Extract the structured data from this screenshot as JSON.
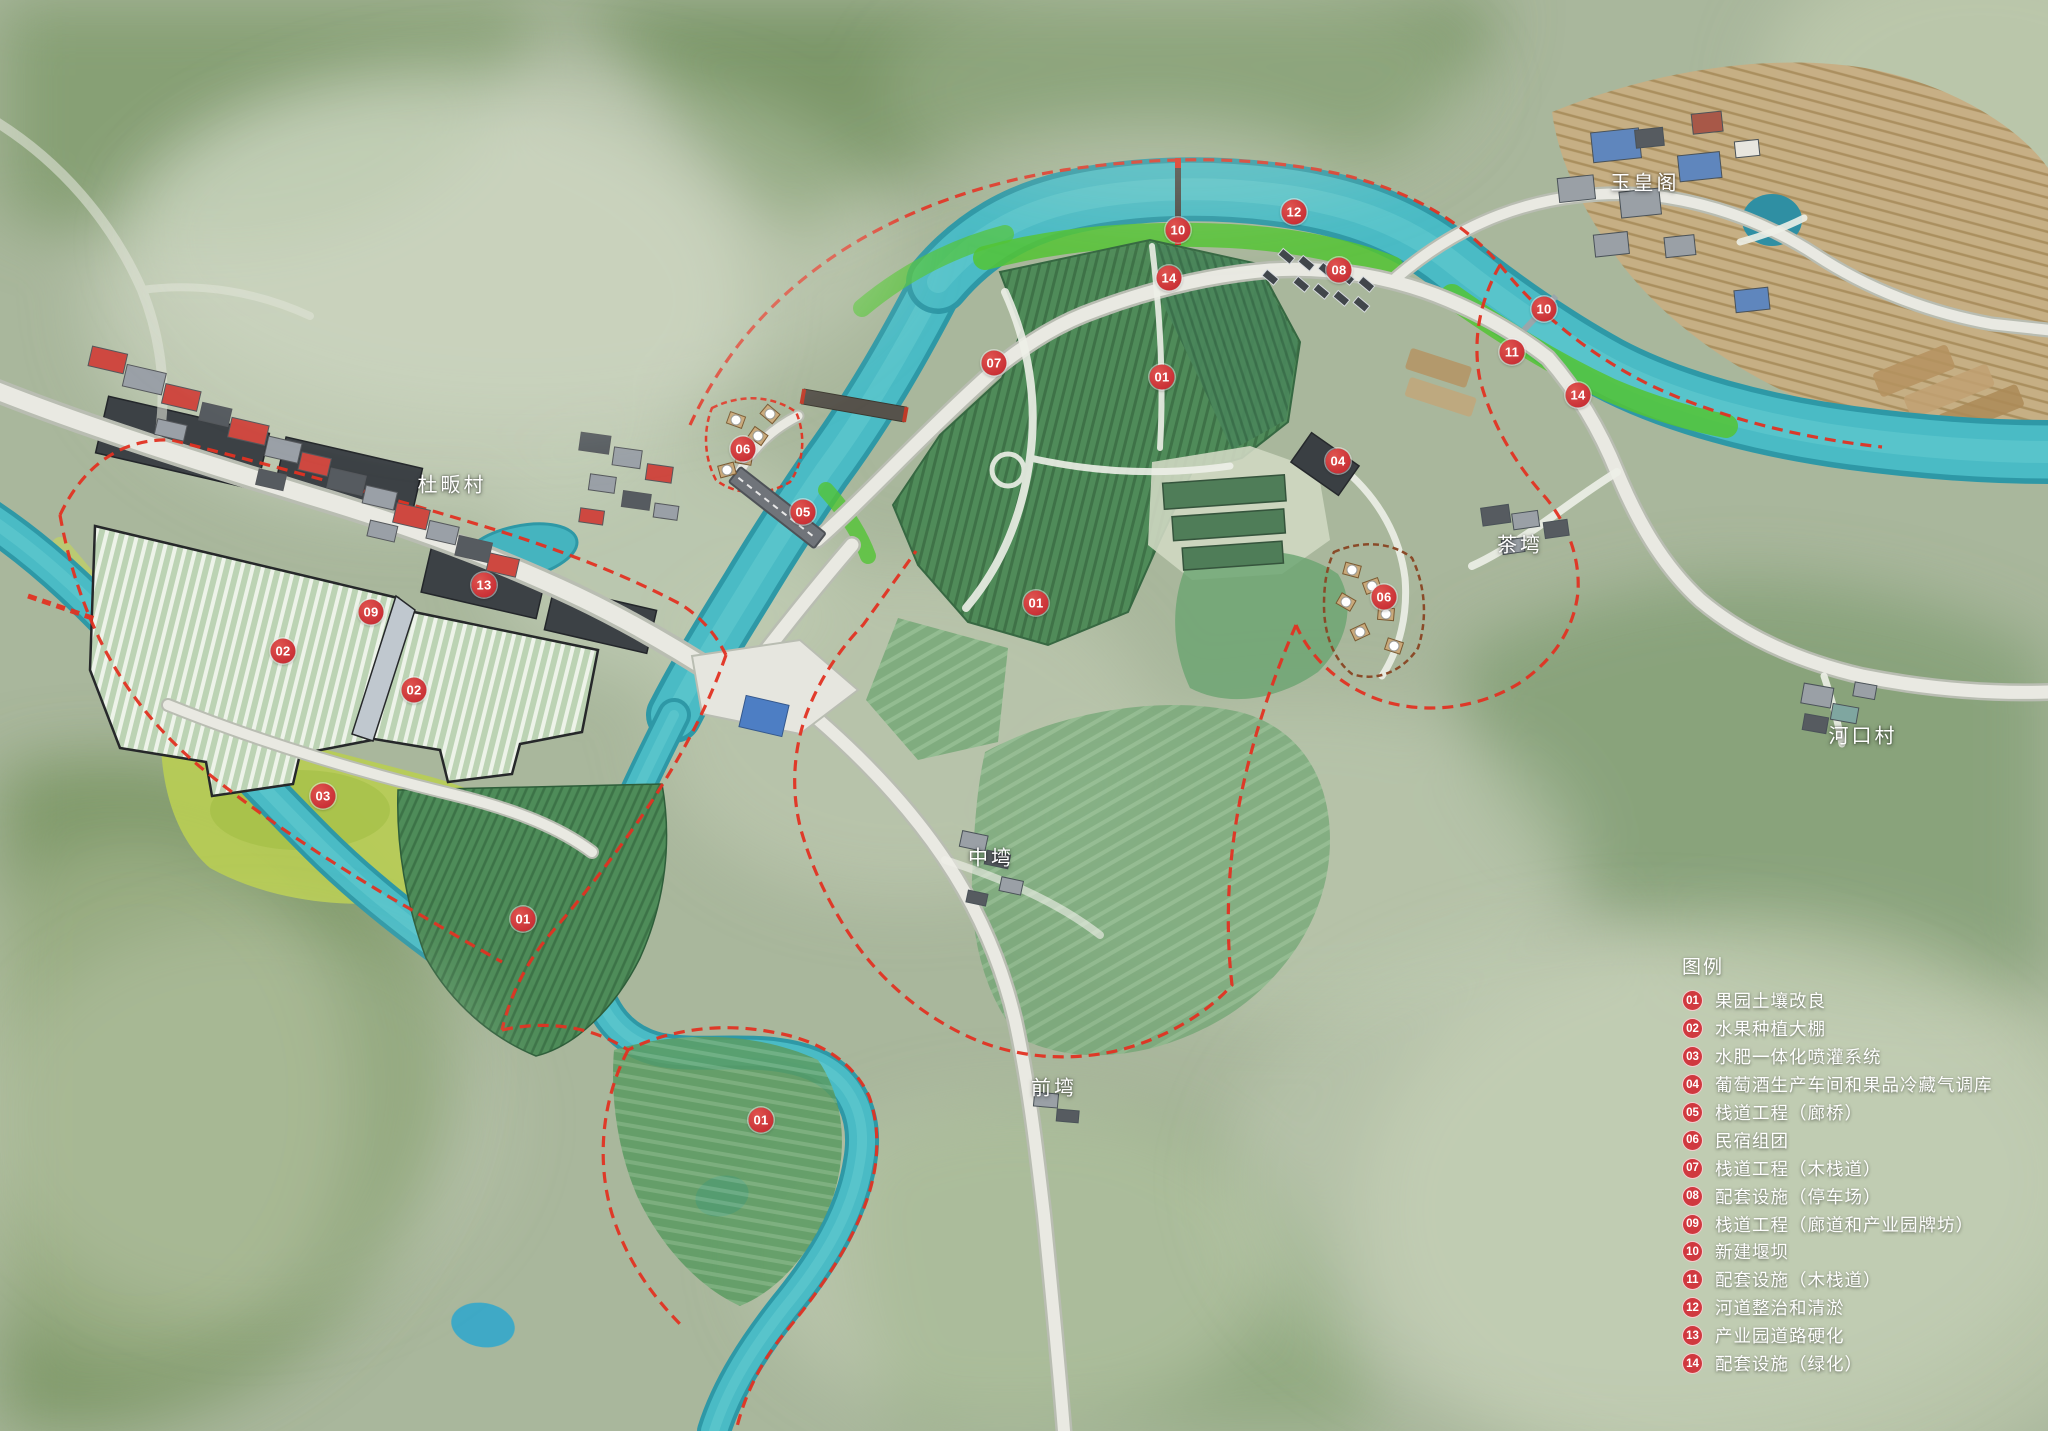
{
  "colors": {
    "marker_red": "#ce383e",
    "badge_red": "#d0393f",
    "river_teal": "#4abbc5",
    "greening_green": "#53c434",
    "boundary_red": "#e23222",
    "label_white": "#ffffff"
  },
  "legend": {
    "title": "图例",
    "items": [
      {
        "num": "01",
        "label": "果园土壤改良"
      },
      {
        "num": "02",
        "label": "水果种植大棚"
      },
      {
        "num": "03",
        "label": "水肥一体化喷灌系统"
      },
      {
        "num": "04",
        "label": "葡萄酒生产车间和果品冷藏气调库"
      },
      {
        "num": "05",
        "label": "栈道工程（廊桥）"
      },
      {
        "num": "06",
        "label": "民宿组团"
      },
      {
        "num": "07",
        "label": "栈道工程（木栈道）"
      },
      {
        "num": "08",
        "label": "配套设施（停车场）"
      },
      {
        "num": "09",
        "label": "栈道工程（廊道和产业园牌坊）"
      },
      {
        "num": "10",
        "label": "新建堰坝"
      },
      {
        "num": "11",
        "label": "配套设施（木栈道）"
      },
      {
        "num": "12",
        "label": "河道整治和清淤"
      },
      {
        "num": "13",
        "label": "产业园道路硬化"
      },
      {
        "num": "14",
        "label": "配套设施（绿化）"
      }
    ]
  },
  "places": [
    {
      "name": "玉皇阁",
      "x": 1645,
      "y": 181
    },
    {
      "name": "杜畈村",
      "x": 452,
      "y": 483
    },
    {
      "name": "中塆",
      "x": 991,
      "y": 856
    },
    {
      "name": "前塆",
      "x": 1054,
      "y": 1086
    },
    {
      "name": "茶塆",
      "x": 1520,
      "y": 543
    },
    {
      "name": "河口村",
      "x": 1863,
      "y": 734
    }
  ],
  "markers": [
    {
      "num": "12",
      "x": 1294,
      "y": 212
    },
    {
      "num": "10",
      "x": 1178,
      "y": 230
    },
    {
      "num": "14",
      "x": 1169,
      "y": 278
    },
    {
      "num": "08",
      "x": 1339,
      "y": 270
    },
    {
      "num": "10",
      "x": 1544,
      "y": 309
    },
    {
      "num": "11",
      "x": 1512,
      "y": 352
    },
    {
      "num": "14",
      "x": 1578,
      "y": 395
    },
    {
      "num": "07",
      "x": 994,
      "y": 363
    },
    {
      "num": "01",
      "x": 1162,
      "y": 377
    },
    {
      "num": "04",
      "x": 1338,
      "y": 461
    },
    {
      "num": "06",
      "x": 743,
      "y": 449
    },
    {
      "num": "05",
      "x": 803,
      "y": 512
    },
    {
      "num": "06",
      "x": 1384,
      "y": 597
    },
    {
      "num": "13",
      "x": 484,
      "y": 585
    },
    {
      "num": "09",
      "x": 371,
      "y": 612
    },
    {
      "num": "02",
      "x": 283,
      "y": 651
    },
    {
      "num": "02",
      "x": 414,
      "y": 690
    },
    {
      "num": "03",
      "x": 323,
      "y": 796
    },
    {
      "num": "01",
      "x": 1036,
      "y": 603
    },
    {
      "num": "01",
      "x": 523,
      "y": 919
    },
    {
      "num": "01",
      "x": 761,
      "y": 1120
    }
  ]
}
